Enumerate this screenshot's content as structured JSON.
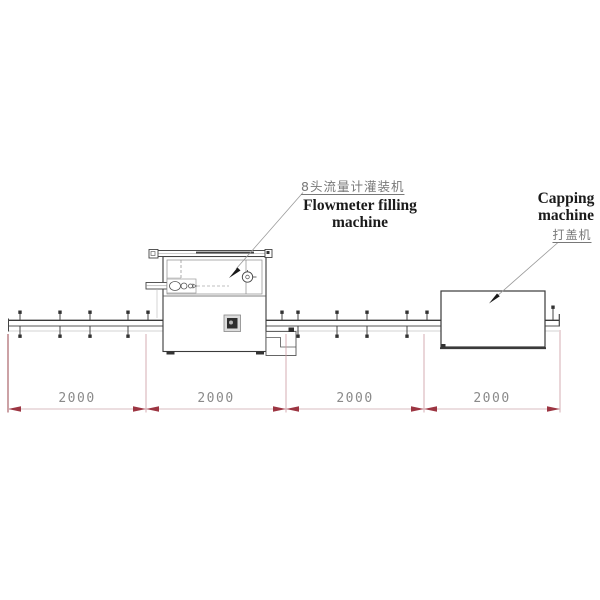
{
  "drawing": {
    "title": "Filling line layout drawing",
    "labels": {
      "filling_machine_cn": "8头流量计灌装机",
      "filling_machine_en_line1": "Flowmeter filling",
      "filling_machine_en_line2": "machine",
      "capping_machine_en_line1": "Capping",
      "capping_machine_en_line2": "machine",
      "capping_machine_cn": "打盖机"
    },
    "dimensions": {
      "segments": [
        {
          "label": "2000"
        },
        {
          "label": "2000"
        },
        {
          "label": "2000"
        },
        {
          "label": "2000"
        }
      ]
    },
    "colors": {
      "drawing_line": "#3a3a3a",
      "dimension_arrow": "#9c3542",
      "dimension_line": "#d9bcc0",
      "extension_line": "#cc9aa0",
      "dimension_text": "#8a8a8a",
      "label_text": "#1b1b1b",
      "cn_text": "#787878"
    }
  }
}
